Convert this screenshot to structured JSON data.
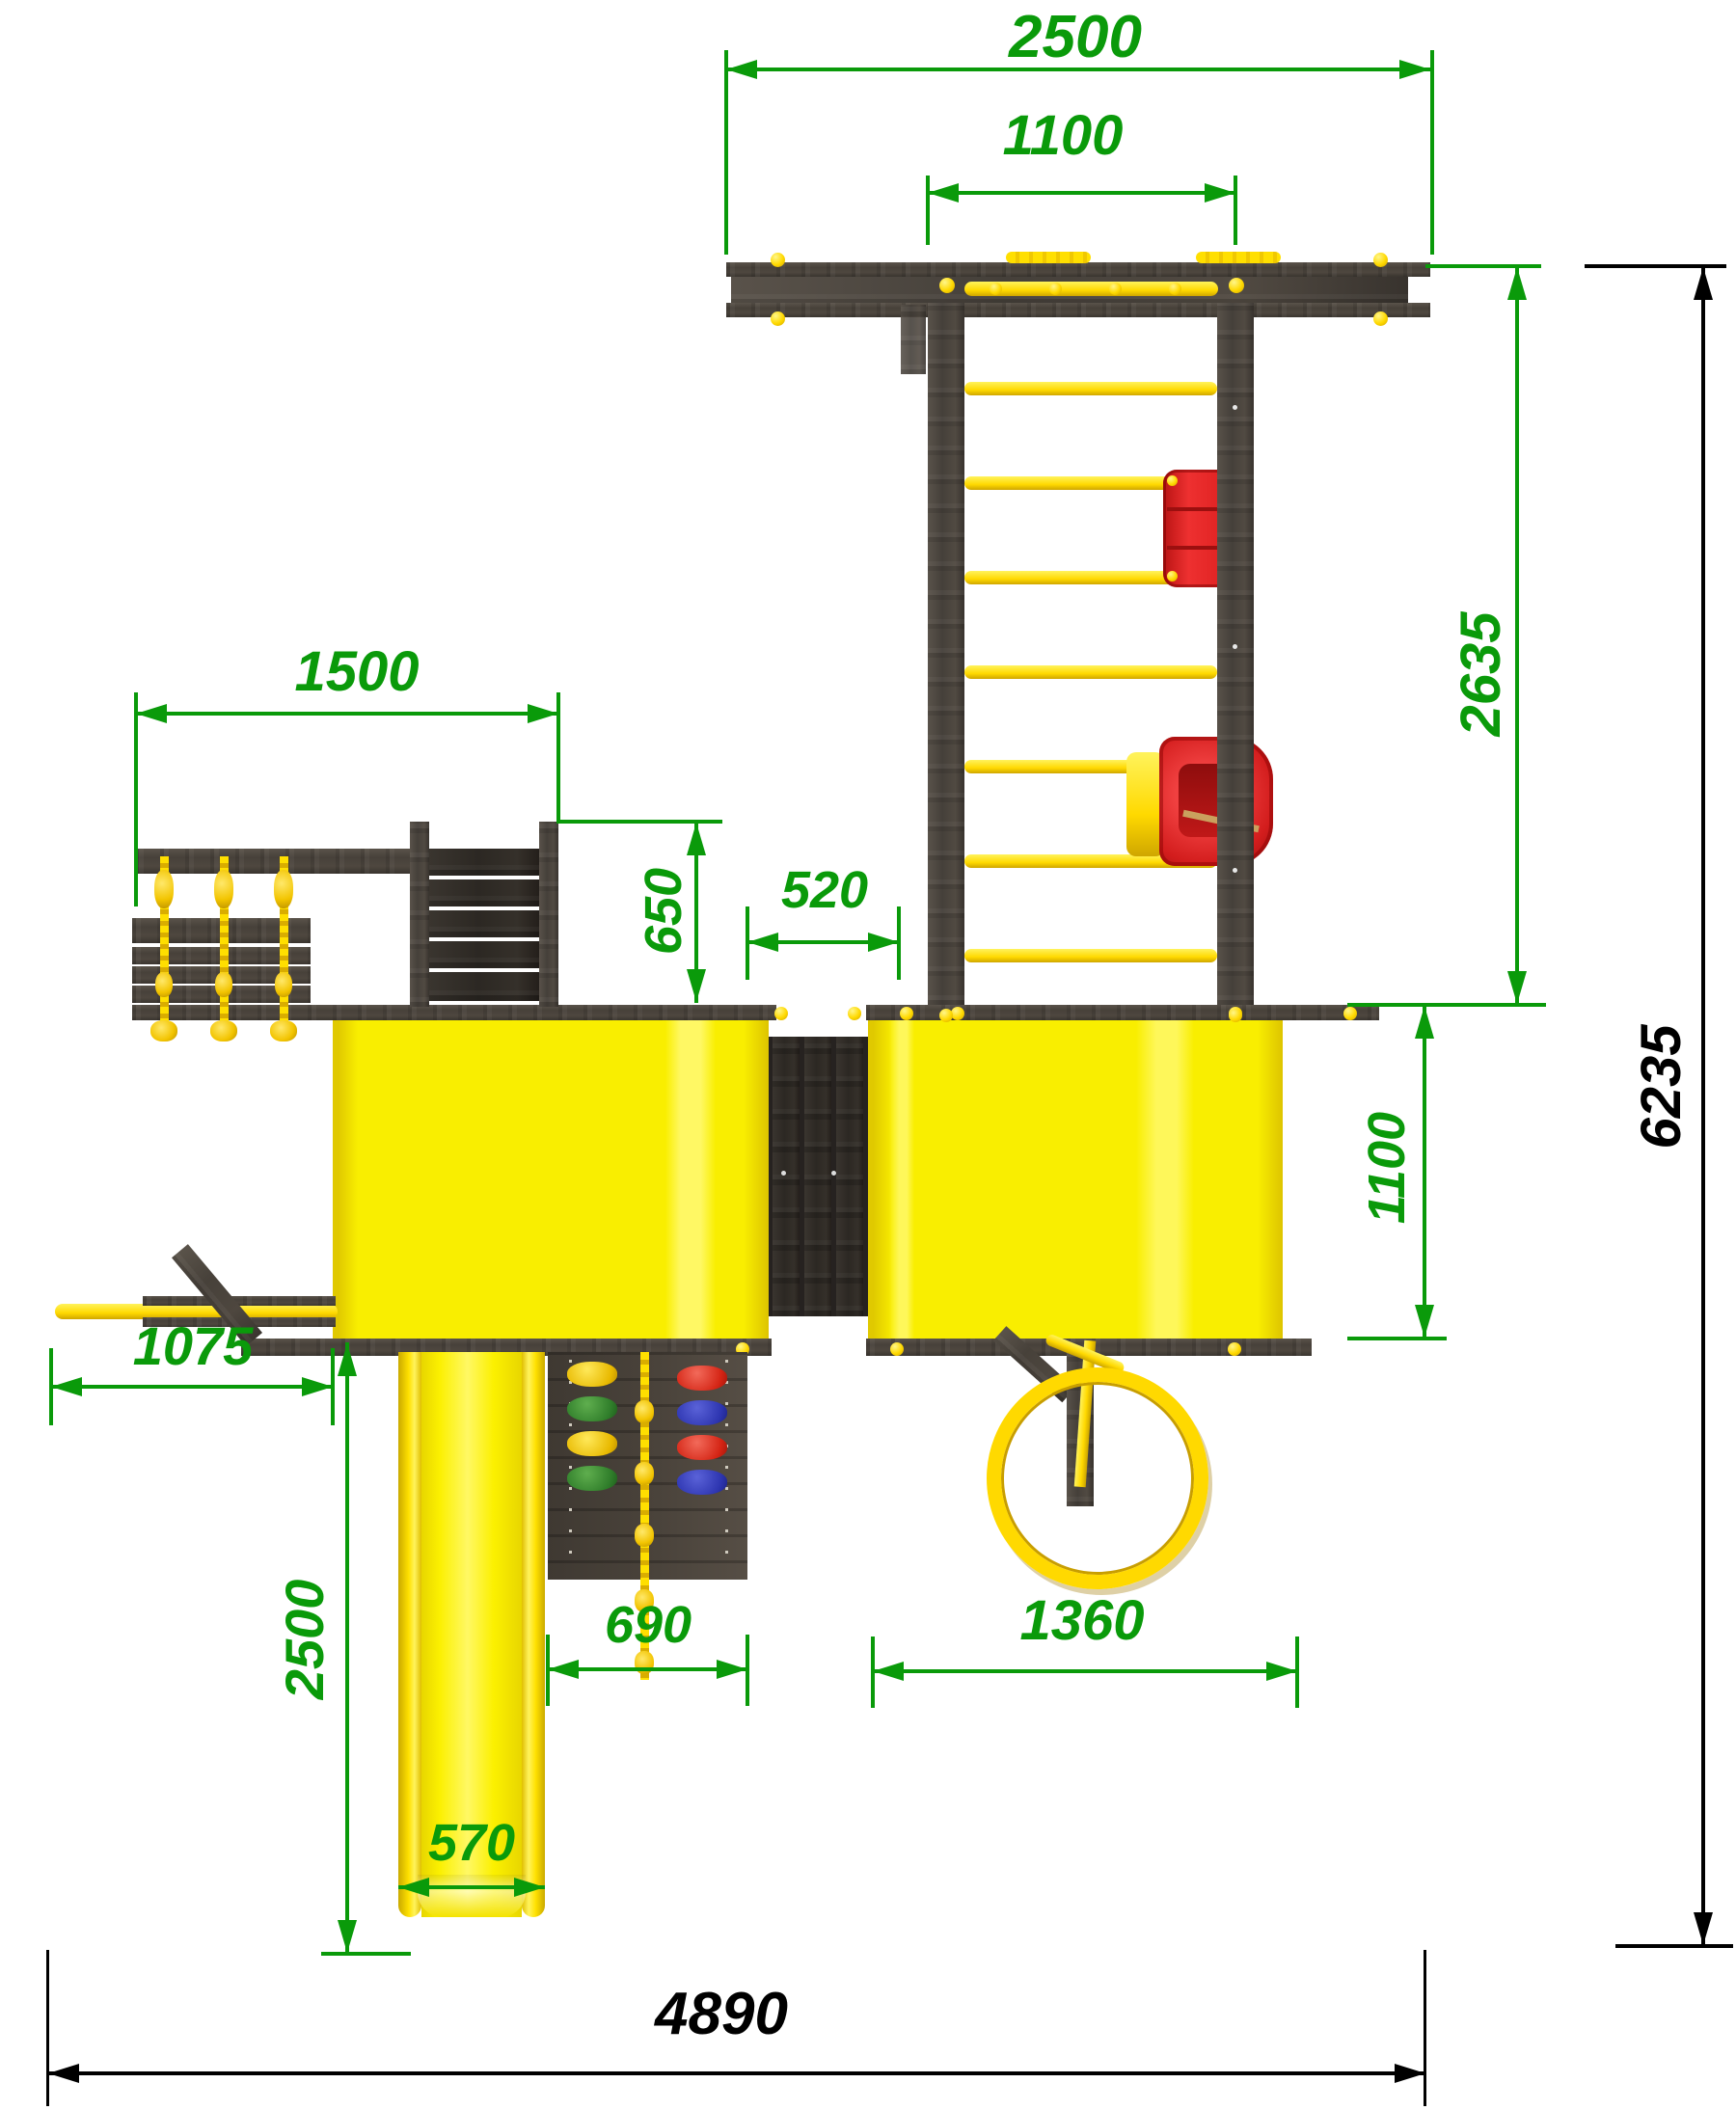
{
  "drawing": {
    "kind": "playground top-view dimension drawing",
    "units": "mm",
    "colors": {
      "dimension_green": "#0a9a0a",
      "dimension_black": "#000000",
      "platform_yellow": "#f9ee00",
      "wood_brown": "#47413a",
      "seat_red": "#e02323",
      "background": "#ffffff"
    },
    "dims": {
      "beam_span": {
        "value": "2500",
        "meaning": "swing beam overall length"
      },
      "rung_span": {
        "value": "1100",
        "meaning": "ladder rung span between posts"
      },
      "ladder_length": {
        "value": "2635",
        "meaning": "swing bay depth from beam to platform"
      },
      "total_depth": {
        "value": "6235",
        "meaning": "overall depth of playset"
      },
      "bench_span": {
        "value": "1500",
        "meaning": "bench hanger beam length"
      },
      "stair_depth": {
        "value": "650",
        "meaning": "stairs depth to platform"
      },
      "bridge_gap": {
        "value": "520",
        "meaning": "gap between towers (bridge)"
      },
      "tower_depth": {
        "value": "1100",
        "meaning": "tower platform depth"
      },
      "entry_offset": {
        "value": "1075",
        "meaning": "entry bar overhang"
      },
      "slide_length": {
        "value": "2500",
        "meaning": "slide run-out length"
      },
      "wall_width": {
        "value": "690",
        "meaning": "climbing wall width"
      },
      "ring_span": {
        "value": "1360",
        "meaning": "ring swing clearance width"
      },
      "slide_width": {
        "value": "570",
        "meaning": "slide width"
      },
      "total_width": {
        "value": "4890",
        "meaning": "overall width of playset"
      }
    }
  }
}
